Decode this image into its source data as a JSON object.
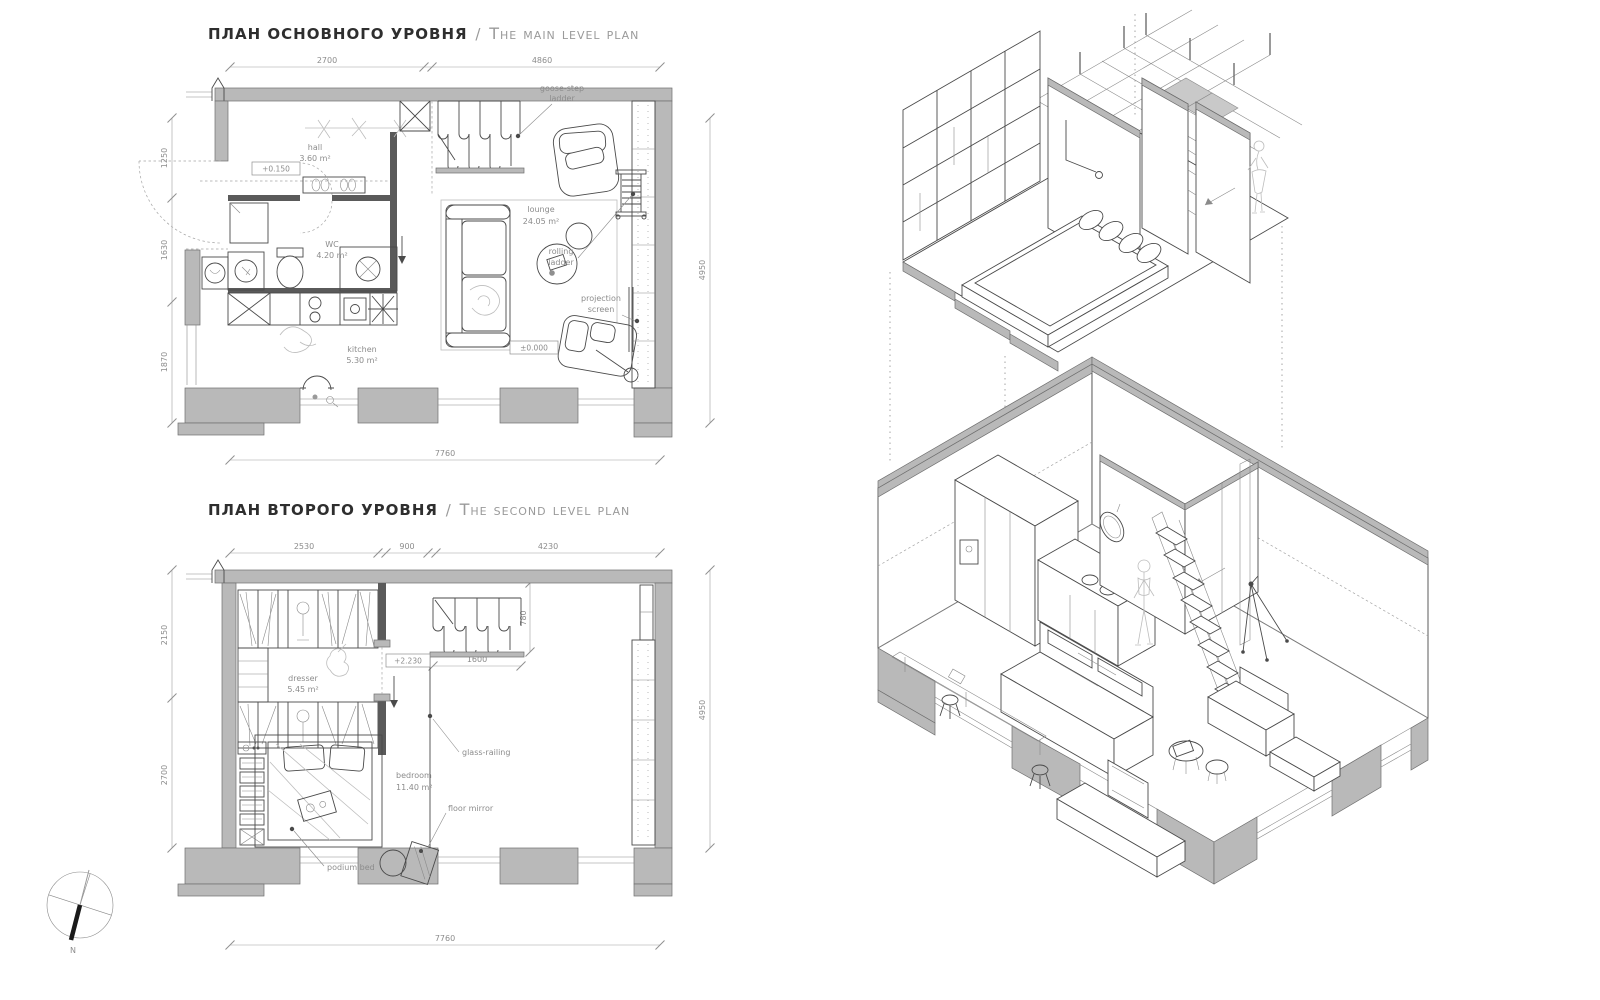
{
  "colors": {
    "wall": "#b9b9b9",
    "partition": "#5a5a5a",
    "line": "#4a4a4a",
    "dim": "#9f9f9f",
    "label": "#8c8c8c"
  },
  "main_plan": {
    "title_ru": "План основного уровня",
    "title_sep": "/",
    "title_en": "The main level plan",
    "dim_top": [
      "2700",
      "4860"
    ],
    "dim_left": [
      "1250",
      "1630",
      "1870"
    ],
    "dim_right": "4950",
    "dim_bottom": "7760",
    "rooms": {
      "hall": {
        "name": "hall",
        "area": "3.60 m²"
      },
      "wc": {
        "name": "WC",
        "area": "4.20 m²"
      },
      "kitchen": {
        "name": "kitchen",
        "area": "5.30 m²"
      },
      "lounge": {
        "name": "lounge",
        "area": "24.05 m²"
      }
    },
    "levels": [
      "+0.150",
      "±0.000"
    ],
    "ann": {
      "goose": [
        "goose-step",
        "ladder"
      ],
      "rolling": [
        "rolling",
        "ladder"
      ],
      "projection": [
        "projection",
        "screen"
      ]
    }
  },
  "second_plan": {
    "title_ru": "План второго уровня",
    "title_sep": "/",
    "title_en": "The second level plan",
    "dim_top": [
      "2530",
      "900",
      "4230"
    ],
    "dim_left": [
      "2150",
      "2700"
    ],
    "dim_right": "4950",
    "dim_bottom": "7760",
    "dim_inner": {
      "h": "1600",
      "v": "780"
    },
    "rooms": {
      "dresser": {
        "name": "dresser",
        "area": "5.45 m²"
      },
      "bedroom": {
        "name": "bedroom",
        "area": "11.40 m²"
      }
    },
    "levels": [
      "+2.230"
    ],
    "ann": {
      "glass": "glass-railing",
      "mirror": "floor mirror",
      "podium": "podium bed"
    }
  },
  "compass": {
    "north": "N"
  }
}
